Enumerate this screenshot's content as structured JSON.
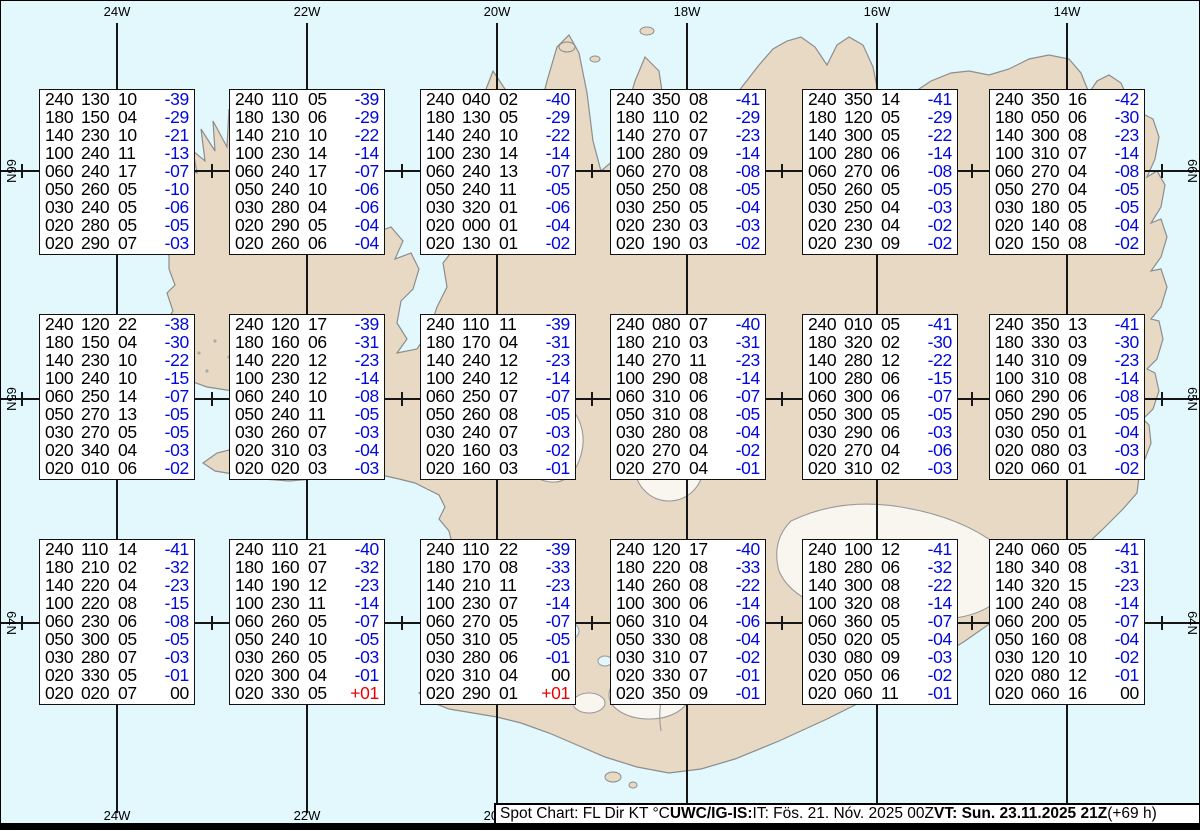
{
  "map": {
    "region": "Iceland",
    "lon_labels": [
      "24W",
      "22W",
      "20W",
      "18W",
      "16W",
      "14W"
    ],
    "lat_labels": [
      "66N",
      "65N",
      "64N"
    ]
  },
  "colors": {
    "ocean": "#e2f8fd",
    "land": "#e7d9c4",
    "temp_negative": "#0008dd",
    "temp_positive": "#ee0000",
    "temp_zero": "#000000"
  },
  "columns_meaning": [
    "FL",
    "Dir",
    "KT",
    "TempC"
  ],
  "boxes": [
    {
      "rows": [
        [
          "240",
          "130",
          "10",
          "-39"
        ],
        [
          "180",
          "150",
          "04",
          "-29"
        ],
        [
          "140",
          "230",
          "10",
          "-21"
        ],
        [
          "100",
          "240",
          "11",
          "-13"
        ],
        [
          "060",
          "240",
          "17",
          "-07"
        ],
        [
          "050",
          "260",
          "05",
          "-10"
        ],
        [
          "030",
          "240",
          "05",
          "-06"
        ],
        [
          "020",
          "280",
          "05",
          "-05"
        ],
        [
          "020",
          "290",
          "07",
          "-03"
        ]
      ]
    },
    {
      "rows": [
        [
          "240",
          "110",
          "05",
          "-39"
        ],
        [
          "180",
          "130",
          "06",
          "-29"
        ],
        [
          "140",
          "210",
          "10",
          "-22"
        ],
        [
          "100",
          "230",
          "14",
          "-14"
        ],
        [
          "060",
          "240",
          "17",
          "-07"
        ],
        [
          "050",
          "240",
          "10",
          "-06"
        ],
        [
          "030",
          "280",
          "04",
          "-06"
        ],
        [
          "020",
          "290",
          "05",
          "-04"
        ],
        [
          "020",
          "260",
          "06",
          "-04"
        ]
      ]
    },
    {
      "rows": [
        [
          "240",
          "040",
          "02",
          "-40"
        ],
        [
          "180",
          "130",
          "05",
          "-29"
        ],
        [
          "140",
          "240",
          "10",
          "-22"
        ],
        [
          "100",
          "230",
          "14",
          "-14"
        ],
        [
          "060",
          "240",
          "13",
          "-07"
        ],
        [
          "050",
          "240",
          "11",
          "-05"
        ],
        [
          "030",
          "320",
          "01",
          "-06"
        ],
        [
          "020",
          "000",
          "01",
          "-04"
        ],
        [
          "020",
          "130",
          "01",
          "-02"
        ]
      ]
    },
    {
      "rows": [
        [
          "240",
          "350",
          "08",
          "-41"
        ],
        [
          "180",
          "110",
          "02",
          "-29"
        ],
        [
          "140",
          "270",
          "07",
          "-23"
        ],
        [
          "100",
          "280",
          "09",
          "-14"
        ],
        [
          "060",
          "270",
          "08",
          "-08"
        ],
        [
          "050",
          "250",
          "08",
          "-05"
        ],
        [
          "030",
          "250",
          "05",
          "-04"
        ],
        [
          "020",
          "230",
          "03",
          "-03"
        ],
        [
          "020",
          "190",
          "03",
          "-02"
        ]
      ]
    },
    {
      "rows": [
        [
          "240",
          "350",
          "14",
          "-41"
        ],
        [
          "180",
          "120",
          "05",
          "-29"
        ],
        [
          "140",
          "300",
          "05",
          "-22"
        ],
        [
          "100",
          "280",
          "06",
          "-14"
        ],
        [
          "060",
          "270",
          "06",
          "-08"
        ],
        [
          "050",
          "260",
          "05",
          "-05"
        ],
        [
          "030",
          "250",
          "04",
          "-03"
        ],
        [
          "020",
          "230",
          "04",
          "-02"
        ],
        [
          "020",
          "230",
          "09",
          "-02"
        ]
      ]
    },
    {
      "rows": [
        [
          "240",
          "350",
          "16",
          "-42"
        ],
        [
          "180",
          "050",
          "06",
          "-30"
        ],
        [
          "140",
          "300",
          "08",
          "-23"
        ],
        [
          "100",
          "310",
          "07",
          "-14"
        ],
        [
          "060",
          "270",
          "04",
          "-08"
        ],
        [
          "050",
          "270",
          "04",
          "-05"
        ],
        [
          "030",
          "180",
          "05",
          "-05"
        ],
        [
          "020",
          "140",
          "08",
          "-04"
        ],
        [
          "020",
          "150",
          "08",
          "-02"
        ]
      ]
    },
    {
      "rows": [
        [
          "240",
          "120",
          "22",
          "-38"
        ],
        [
          "180",
          "150",
          "04",
          "-30"
        ],
        [
          "140",
          "230",
          "10",
          "-22"
        ],
        [
          "100",
          "240",
          "10",
          "-15"
        ],
        [
          "060",
          "250",
          "14",
          "-07"
        ],
        [
          "050",
          "270",
          "13",
          "-05"
        ],
        [
          "030",
          "270",
          "05",
          "-05"
        ],
        [
          "020",
          "340",
          "04",
          "-03"
        ],
        [
          "020",
          "010",
          "06",
          "-02"
        ]
      ]
    },
    {
      "rows": [
        [
          "240",
          "120",
          "17",
          "-39"
        ],
        [
          "180",
          "160",
          "06",
          "-31"
        ],
        [
          "140",
          "220",
          "12",
          "-23"
        ],
        [
          "100",
          "230",
          "12",
          "-14"
        ],
        [
          "060",
          "240",
          "10",
          "-08"
        ],
        [
          "050",
          "240",
          "11",
          "-05"
        ],
        [
          "030",
          "260",
          "07",
          "-03"
        ],
        [
          "020",
          "310",
          "03",
          "-04"
        ],
        [
          "020",
          "020",
          "03",
          "-03"
        ]
      ]
    },
    {
      "rows": [
        [
          "240",
          "110",
          "11",
          "-39"
        ],
        [
          "180",
          "170",
          "04",
          "-31"
        ],
        [
          "140",
          "240",
          "12",
          "-23"
        ],
        [
          "100",
          "240",
          "12",
          "-14"
        ],
        [
          "060",
          "250",
          "07",
          "-07"
        ],
        [
          "050",
          "260",
          "08",
          "-05"
        ],
        [
          "030",
          "240",
          "07",
          "-03"
        ],
        [
          "020",
          "160",
          "03",
          "-02"
        ],
        [
          "020",
          "160",
          "03",
          "-01"
        ]
      ]
    },
    {
      "rows": [
        [
          "240",
          "080",
          "07",
          "-40"
        ],
        [
          "180",
          "210",
          "03",
          "-31"
        ],
        [
          "140",
          "270",
          "11",
          "-23"
        ],
        [
          "100",
          "290",
          "08",
          "-14"
        ],
        [
          "060",
          "310",
          "06",
          "-07"
        ],
        [
          "050",
          "310",
          "08",
          "-05"
        ],
        [
          "030",
          "280",
          "08",
          "-04"
        ],
        [
          "020",
          "270",
          "04",
          "-02"
        ],
        [
          "020",
          "270",
          "04",
          "-01"
        ]
      ]
    },
    {
      "rows": [
        [
          "240",
          "010",
          "05",
          "-41"
        ],
        [
          "180",
          "320",
          "02",
          "-30"
        ],
        [
          "140",
          "280",
          "12",
          "-22"
        ],
        [
          "100",
          "280",
          "06",
          "-15"
        ],
        [
          "060",
          "300",
          "06",
          "-07"
        ],
        [
          "050",
          "300",
          "05",
          "-05"
        ],
        [
          "030",
          "290",
          "06",
          "-03"
        ],
        [
          "020",
          "270",
          "04",
          "-06"
        ],
        [
          "020",
          "310",
          "02",
          "-03"
        ]
      ]
    },
    {
      "rows": [
        [
          "240",
          "350",
          "13",
          "-41"
        ],
        [
          "180",
          "330",
          "03",
          "-30"
        ],
        [
          "140",
          "310",
          "09",
          "-23"
        ],
        [
          "100",
          "310",
          "08",
          "-14"
        ],
        [
          "060",
          "290",
          "06",
          "-08"
        ],
        [
          "050",
          "290",
          "05",
          "-05"
        ],
        [
          "030",
          "050",
          "01",
          "-04"
        ],
        [
          "020",
          "080",
          "03",
          "-03"
        ],
        [
          "020",
          "060",
          "01",
          "-02"
        ]
      ]
    },
    {
      "rows": [
        [
          "240",
          "110",
          "14",
          "-41"
        ],
        [
          "180",
          "210",
          "02",
          "-32"
        ],
        [
          "140",
          "220",
          "04",
          "-23"
        ],
        [
          "100",
          "220",
          "08",
          "-15"
        ],
        [
          "060",
          "230",
          "06",
          "-08"
        ],
        [
          "050",
          "300",
          "05",
          "-05"
        ],
        [
          "030",
          "280",
          "07",
          "-03"
        ],
        [
          "020",
          "330",
          "05",
          "-01"
        ],
        [
          "020",
          "020",
          "07",
          "00"
        ]
      ]
    },
    {
      "rows": [
        [
          "240",
          "110",
          "21",
          "-40"
        ],
        [
          "180",
          "160",
          "07",
          "-32"
        ],
        [
          "140",
          "190",
          "12",
          "-23"
        ],
        [
          "100",
          "230",
          "11",
          "-14"
        ],
        [
          "060",
          "260",
          "05",
          "-07"
        ],
        [
          "050",
          "240",
          "10",
          "-05"
        ],
        [
          "030",
          "260",
          "05",
          "-03"
        ],
        [
          "020",
          "300",
          "04",
          "-01"
        ],
        [
          "020",
          "330",
          "05",
          "+01"
        ]
      ]
    },
    {
      "rows": [
        [
          "240",
          "110",
          "22",
          "-39"
        ],
        [
          "180",
          "170",
          "08",
          "-33"
        ],
        [
          "140",
          "210",
          "11",
          "-23"
        ],
        [
          "100",
          "230",
          "07",
          "-14"
        ],
        [
          "060",
          "270",
          "05",
          "-07"
        ],
        [
          "050",
          "310",
          "05",
          "-05"
        ],
        [
          "030",
          "280",
          "06",
          "-01"
        ],
        [
          "020",
          "310",
          "04",
          "00"
        ],
        [
          "020",
          "290",
          "01",
          "+01"
        ]
      ]
    },
    {
      "rows": [
        [
          "240",
          "120",
          "17",
          "-40"
        ],
        [
          "180",
          "220",
          "08",
          "-33"
        ],
        [
          "140",
          "260",
          "08",
          "-22"
        ],
        [
          "100",
          "300",
          "06",
          "-14"
        ],
        [
          "060",
          "310",
          "04",
          "-06"
        ],
        [
          "050",
          "330",
          "08",
          "-04"
        ],
        [
          "030",
          "310",
          "07",
          "-02"
        ],
        [
          "020",
          "330",
          "07",
          "-01"
        ],
        [
          "020",
          "350",
          "09",
          "-01"
        ]
      ]
    },
    {
      "rows": [
        [
          "240",
          "100",
          "12",
          "-41"
        ],
        [
          "180",
          "280",
          "06",
          "-32"
        ],
        [
          "140",
          "300",
          "08",
          "-22"
        ],
        [
          "100",
          "320",
          "08",
          "-14"
        ],
        [
          "060",
          "360",
          "05",
          "-07"
        ],
        [
          "050",
          "020",
          "05",
          "-04"
        ],
        [
          "030",
          "080",
          "09",
          "-03"
        ],
        [
          "020",
          "050",
          "06",
          "-02"
        ],
        [
          "020",
          "060",
          "11",
          "-01"
        ]
      ]
    },
    {
      "rows": [
        [
          "240",
          "060",
          "05",
          "-41"
        ],
        [
          "180",
          "340",
          "08",
          "-31"
        ],
        [
          "140",
          "320",
          "15",
          "-23"
        ],
        [
          "100",
          "240",
          "08",
          "-14"
        ],
        [
          "060",
          "200",
          "05",
          "-07"
        ],
        [
          "050",
          "160",
          "08",
          "-04"
        ],
        [
          "030",
          "120",
          "10",
          "-02"
        ],
        [
          "020",
          "080",
          "12",
          "-01"
        ],
        [
          "020",
          "060",
          "16",
          "00"
        ]
      ]
    }
  ],
  "status_bar": {
    "parts": [
      {
        "text": "Spot Chart: FL Dir KT °C ",
        "bold": false
      },
      {
        "text": "UWC/IG-IS:",
        "bold": true
      },
      {
        "text": " IT: Fös. 21. Nóv. 2025 00Z ",
        "bold": false
      },
      {
        "text": "VT: Sun. 23.11.2025 21Z",
        "bold": true
      },
      {
        "text": " (+69 h)",
        "bold": false
      }
    ]
  }
}
